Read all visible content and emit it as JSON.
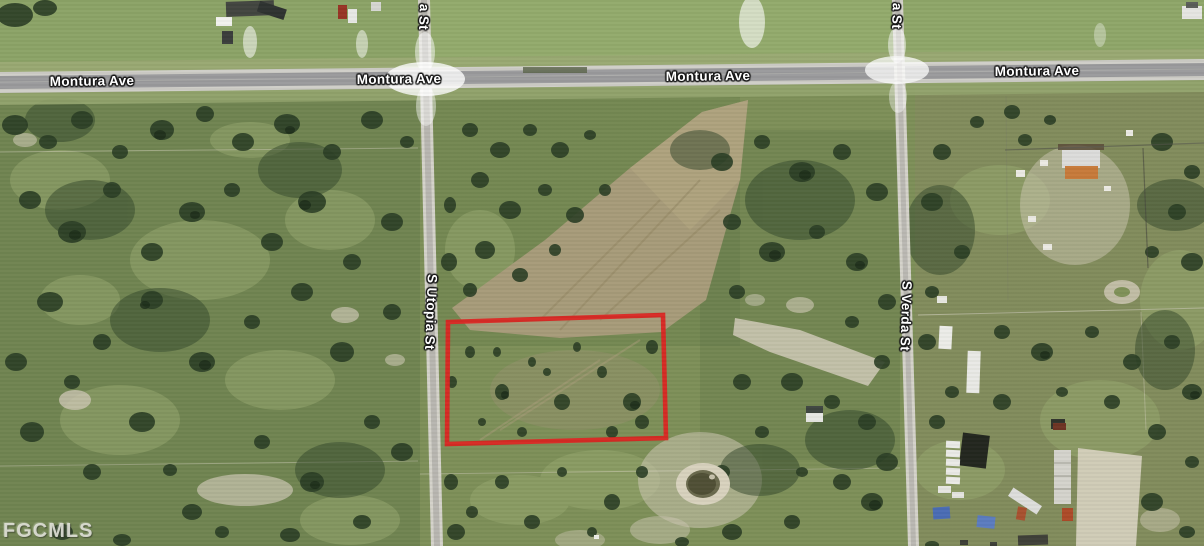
{
  "map": {
    "watermark": "FGCMLS",
    "streets": {
      "montura": "Montura Ave",
      "utopia": "S Utopia St",
      "verda": "S Verda St",
      "utopia_top_fragment": "a St",
      "verda_top_fragment": "a St"
    },
    "parcel": {
      "outline_color": "#da2622"
    }
  }
}
